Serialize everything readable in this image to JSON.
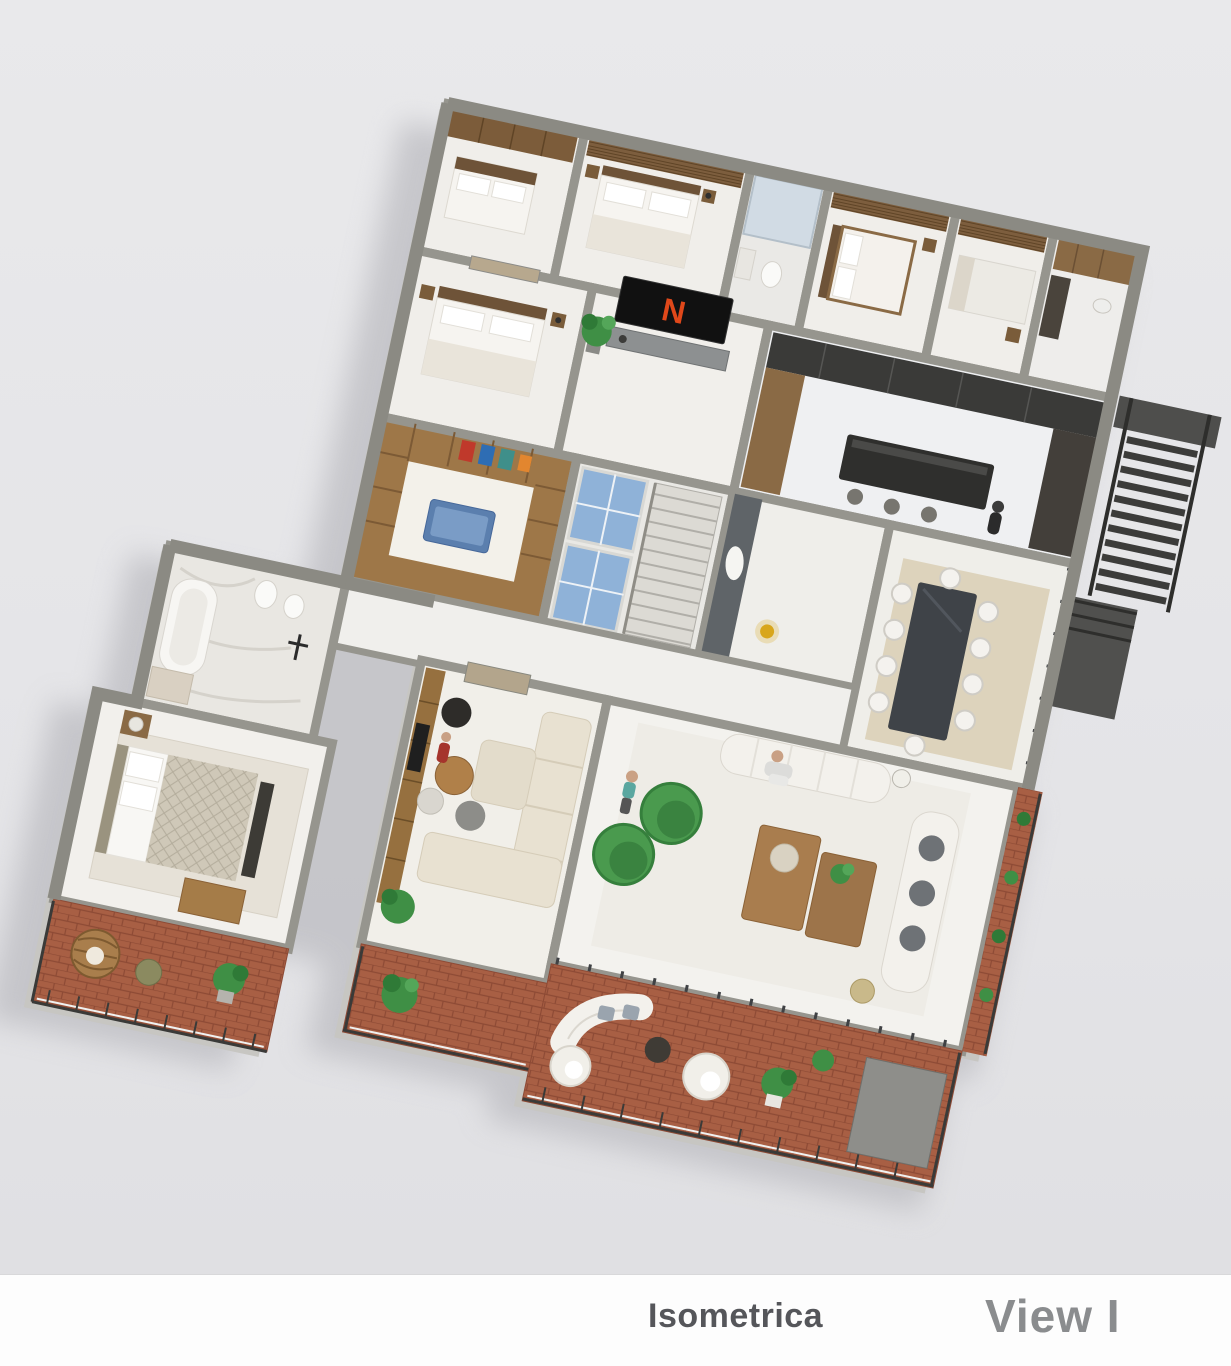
{
  "caption": {
    "title": "Isometrica",
    "view_label": "View I"
  },
  "tv": {
    "logo_letter": "N"
  },
  "scene": {
    "type": "isometric-3d-floor-plan-render",
    "rooms": [
      "bedroom-1",
      "bedroom-2",
      "bathroom-1",
      "bedroom-3",
      "bedroom-4",
      "service-room",
      "bedroom-5",
      "media-wall-hall",
      "kitchen",
      "walk-in-closet",
      "stair-core",
      "foyer",
      "dining-room",
      "master-bathroom",
      "master-bedroom",
      "tv-lounge",
      "living-room",
      "left-terrace",
      "main-terrace",
      "side-terrace",
      "external-staircase"
    ],
    "people_count": 4,
    "dining_chair_count": 10
  },
  "colors": {
    "background": "#e6e6e8",
    "caption_bg": "#fdfdfd",
    "wall_gray": "#96958e",
    "floor_white": "#f2f1ed",
    "terracotta": "#a85f44",
    "terracotta_line": "#8d4a35",
    "wood": "#a07a4e",
    "dark_wood": "#6e5338",
    "chair_green": "#4a9a4e",
    "chair_green_dark": "#3a8340",
    "plant_green": "#3f8f45",
    "netflix_red": "#e0481a",
    "glass_blue": "#8fb2d8",
    "shower_glass": "#cdd9e4",
    "sofa_cream": "#e8e1d1",
    "sofa_white": "#f3f1ec",
    "kitchen_dark": "#3a3a38",
    "island_blue": "#5b7fae",
    "metal_dark": "#3c3c3a",
    "accent_gold": "#d8a61d"
  }
}
